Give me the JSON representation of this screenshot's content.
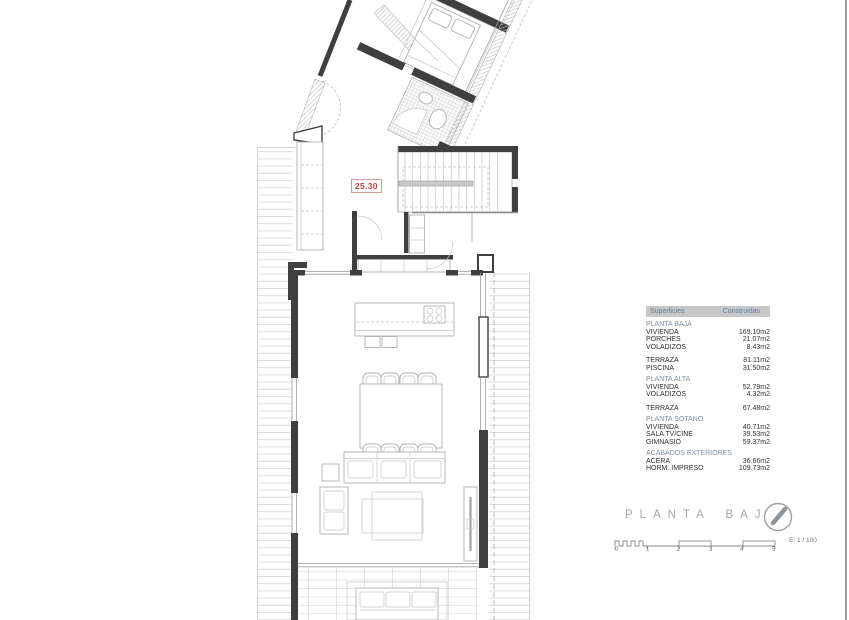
{
  "dimension_label": "25.30",
  "plan_title": "PLANTA BAJA",
  "areas_table": {
    "headers": [
      "Superficies",
      "Construidas"
    ],
    "rows": [
      {
        "type": "section",
        "label": "PLANTA BAJA",
        "value": ""
      },
      {
        "type": "item",
        "label": "VIVIENDA",
        "value": "169.10m2"
      },
      {
        "type": "item",
        "label": "PORCHES",
        "value": "21.07m2"
      },
      {
        "type": "item",
        "label": "VOLADIZOS",
        "value": "8.43m2"
      },
      {
        "type": "item",
        "label": "TERRAZA",
        "value": "81.11m2"
      },
      {
        "type": "item",
        "label": "PISCINA",
        "value": "31.50m2"
      },
      {
        "type": "section",
        "label": "PLANTA ALTA",
        "value": ""
      },
      {
        "type": "item",
        "label": "VIVIENDA",
        "value": "52.79m2"
      },
      {
        "type": "item",
        "label": "VOLADIZOS",
        "value": "4.32m2"
      },
      {
        "type": "item",
        "label": "TERRAZA",
        "value": "67.48m2"
      },
      {
        "type": "section",
        "label": "PLANTA SOTANO",
        "value": ""
      },
      {
        "type": "item",
        "label": "VIVIENDA",
        "value": "40.71m2"
      },
      {
        "type": "item",
        "label": "SALA TV/CINE",
        "value": "39.53m2"
      },
      {
        "type": "item",
        "label": "GIMNASIO",
        "value": "59.37m2"
      },
      {
        "type": "section",
        "label": "ACABADOS EXTERIORES",
        "value": ""
      },
      {
        "type": "item",
        "label": "ACERA",
        "value": "36.66m2"
      },
      {
        "type": "item",
        "label": "HORM. IMPRESO",
        "value": "109.73m2"
      }
    ]
  },
  "scalebar": {
    "labels": [
      "0",
      "1",
      "2",
      "3",
      "4",
      "5"
    ],
    "scale_text": "E: 1 / 100"
  },
  "colors": {
    "dimension_red": "#b5443c",
    "table_header_bg": "#c7c7c7",
    "table_header_text": "#5e7f9c",
    "section_text": "#7b90a5",
    "title_gray": "#a6a6a6",
    "wall_dark": "#3f3f3f"
  }
}
